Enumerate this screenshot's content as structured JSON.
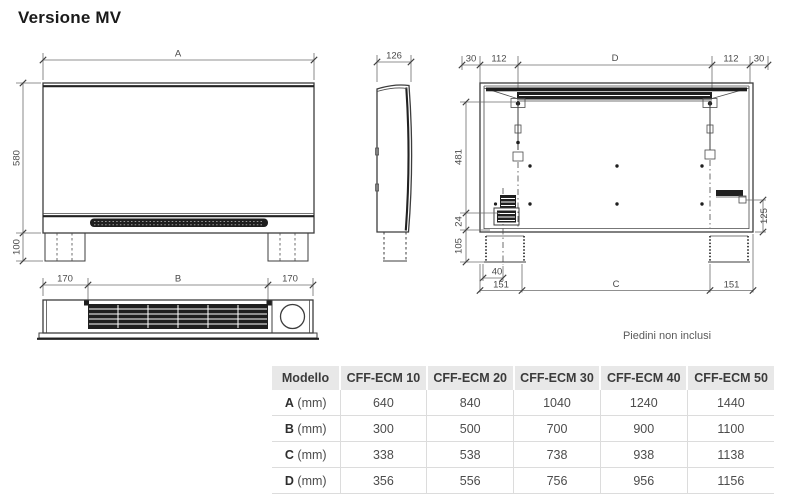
{
  "title": "Versione MV",
  "note": "Piedini non inclusi",
  "drawing": {
    "front": {
      "width": "A",
      "height": "580",
      "feet": "100"
    },
    "side": {
      "depth": "126"
    },
    "top_view": {
      "left": "170",
      "center": "B",
      "right": "170"
    },
    "rear": {
      "top": [
        "30",
        "112",
        "D",
        "112",
        "30"
      ],
      "left": [
        "481",
        "24",
        "105"
      ],
      "bottom": [
        "40",
        "151",
        "C",
        "151"
      ],
      "right": "125"
    }
  },
  "table": {
    "headers": [
      "Modello",
      "CFF-ECM 10",
      "CFF-ECM 20",
      "CFF-ECM 30",
      "CFF-ECM 40",
      "CFF-ECM 50"
    ],
    "rows": [
      {
        "label": "A",
        "unit": "(mm)",
        "values": [
          "640",
          "840",
          "1040",
          "1240",
          "1440"
        ]
      },
      {
        "label": "B",
        "unit": "(mm)",
        "values": [
          "300",
          "500",
          "700",
          "900",
          "1100"
        ]
      },
      {
        "label": "C",
        "unit": "(mm)",
        "values": [
          "338",
          "538",
          "738",
          "938",
          "1138"
        ]
      },
      {
        "label": "D",
        "unit": "(mm)",
        "values": [
          "356",
          "556",
          "756",
          "956",
          "1156"
        ]
      }
    ]
  },
  "colors": {
    "line": "#3d3d3d",
    "dim_text": "#4a4a4a",
    "table_header_bg": "#e8e8e8",
    "table_border": "#dcdcdc"
  }
}
